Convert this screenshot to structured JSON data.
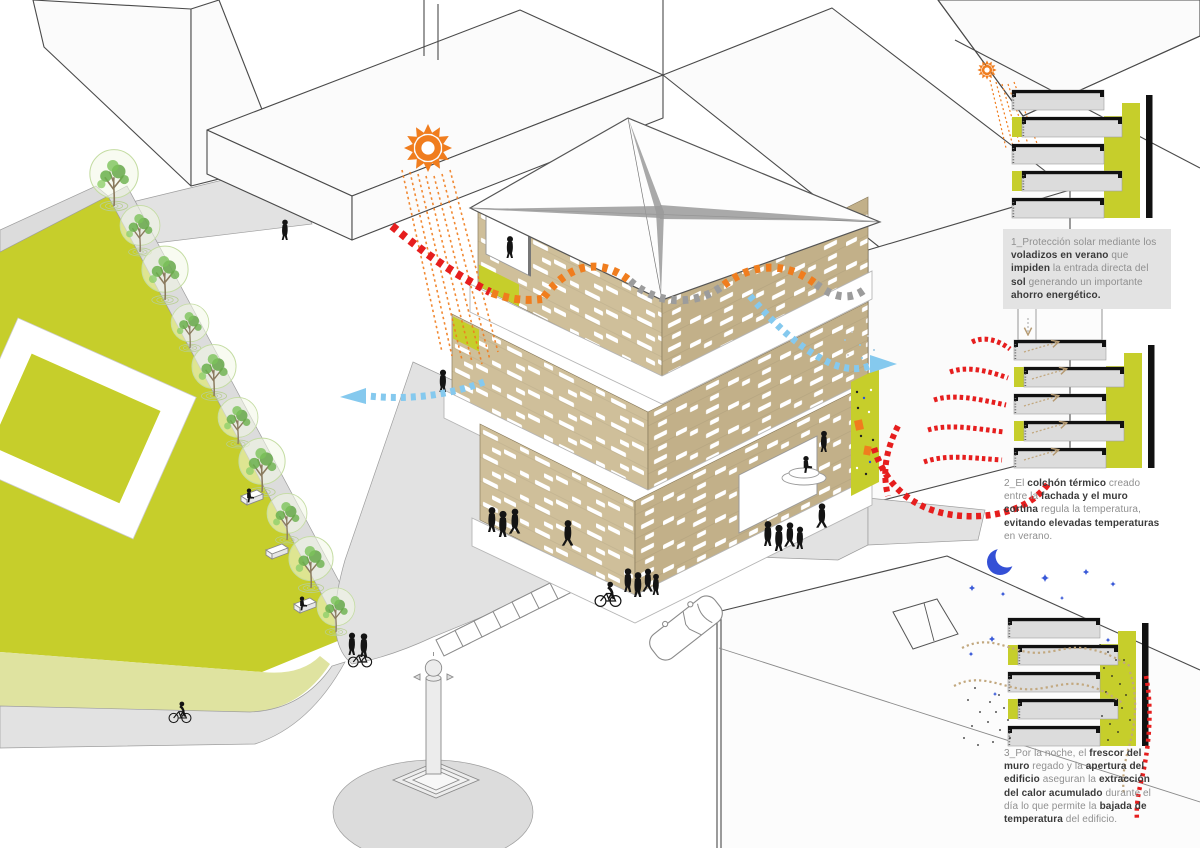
{
  "meta": {
    "kind": "architectural-bioclimatic-diagram",
    "language": "es",
    "scene": "isometric urban block with timber-slat building, park, and three facade section details (summer day, thermal buffer, night cooling)"
  },
  "palette": {
    "green": "#c6ce2b",
    "paleGreen": "#dfe3a0",
    "wood": "#cfbf9a",
    "woodDark": "#c2b089",
    "orange": "#f07d1e",
    "red": "#e61e1e",
    "skyBlue": "#85c9ee",
    "grayArrow": "#9c9c9c",
    "moonBlue": "#3450d6",
    "slabGray": "#dcdcdc",
    "noteBg": "#e3e3e3",
    "text": "#8f8f8f",
    "textBold": "#3a3a3a"
  },
  "icons": {
    "sun_large": "sun-icon",
    "sun_small": "sun-icon",
    "moon": "moon-icon",
    "stars": "star-icon"
  },
  "notes": [
    {
      "id": "1",
      "background": true,
      "segments": [
        {
          "t": "1_Protección solar mediante los ",
          "b": false
        },
        {
          "t": "voladizos en verano",
          "b": true
        },
        {
          "t": " que ",
          "b": false
        },
        {
          "t": "impiden",
          "b": true
        },
        {
          "t": " la entrada directa del ",
          "b": false
        },
        {
          "t": "sol",
          "b": true
        },
        {
          "t": " generando un importante ",
          "b": false
        },
        {
          "t": "ahorro energético.",
          "b": true
        }
      ]
    },
    {
      "id": "2",
      "background": false,
      "segments": [
        {
          "t": "2_El ",
          "b": false
        },
        {
          "t": "colchón térmico",
          "b": true
        },
        {
          "t": " creado entre la ",
          "b": false
        },
        {
          "t": "fachada y el muro cortina",
          "b": true
        },
        {
          "t": " regula la temperatura, ",
          "b": false
        },
        {
          "t": "evitando elevadas temperaturas",
          "b": true
        },
        {
          "t": " en verano.",
          "b": false
        }
      ]
    },
    {
      "id": "3",
      "background": false,
      "segments": [
        {
          "t": "3_Por la noche, el ",
          "b": false
        },
        {
          "t": "frescor del muro",
          "b": true
        },
        {
          "t": " regado y la ",
          "b": false
        },
        {
          "t": "apertura del edificio",
          "b": true
        },
        {
          "t": " aseguran la ",
          "b": false
        },
        {
          "t": "extracción del calor acumulado",
          "b": true
        },
        {
          "t": " durante el día lo que permite la ",
          "b": false
        },
        {
          "t": "bajada de temperatura",
          "b": true
        },
        {
          "t": " del edificio.",
          "b": false
        }
      ]
    }
  ]
}
